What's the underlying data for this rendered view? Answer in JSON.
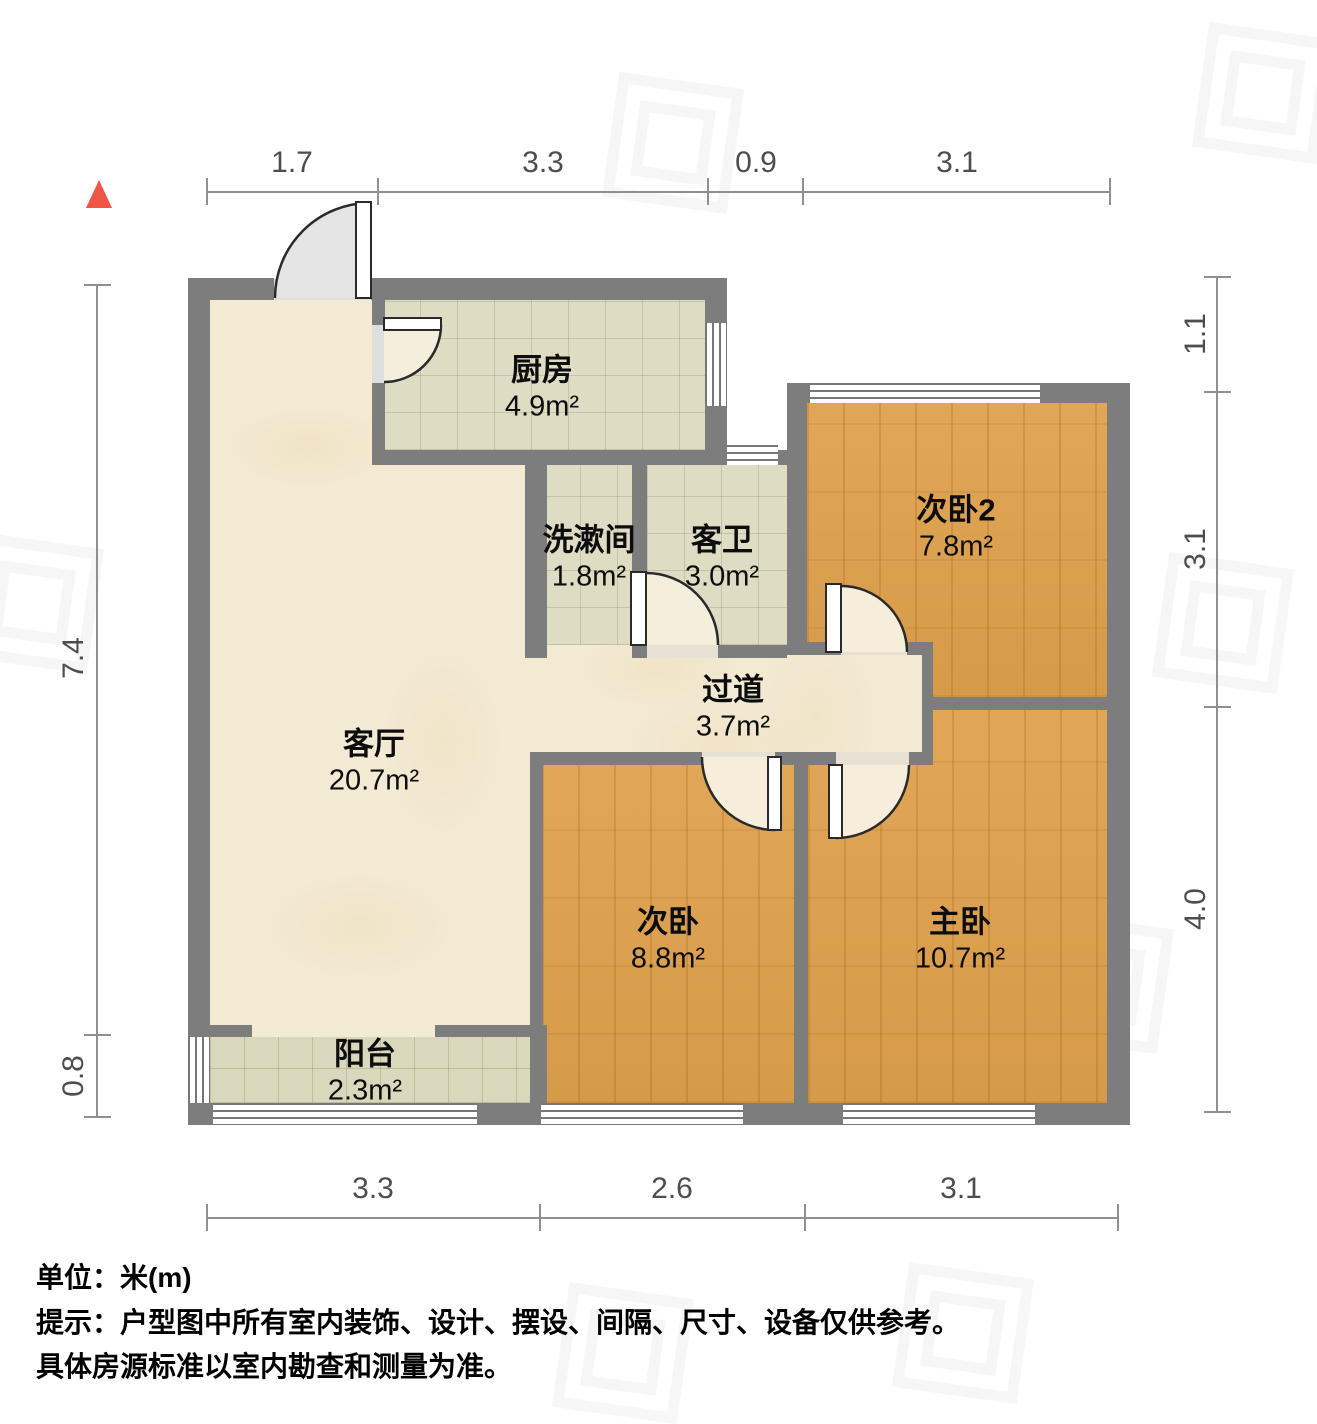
{
  "title": "户型图",
  "unit_scale": "米",
  "rooms": {
    "kitchen": {
      "name": "厨房",
      "area": "4.9m²"
    },
    "washroom": {
      "name": "洗漱间",
      "area": "1.8m²"
    },
    "guest_bath": {
      "name": "客卫",
      "area": "3.0m²"
    },
    "bedroom2": {
      "name": "次卧2",
      "area": "7.8m²"
    },
    "hallway": {
      "name": "过道",
      "area": "3.7m²"
    },
    "living": {
      "name": "客厅",
      "area": "20.7m²"
    },
    "bedroom": {
      "name": "次卧",
      "area": "8.8m²"
    },
    "master": {
      "name": "主卧",
      "area": "10.7m²"
    },
    "balcony": {
      "name": "阳台",
      "area": "2.3m²"
    }
  },
  "dims": {
    "top": [
      "1.7",
      "3.3",
      "0.9",
      "3.1"
    ],
    "bottom": [
      "3.3",
      "2.6",
      "3.1"
    ],
    "left": [
      "7.4",
      "0.8"
    ],
    "right": [
      "1.1",
      "3.1",
      "4.0"
    ]
  },
  "footer": {
    "unit": "单位：米(m)",
    "note1": "提示：户型图中所有室内装饰、设计、摆设、间隔、尺寸、设备仅供参考。",
    "note2": "具体房源标准以室内勘查和测量为准。"
  },
  "colors": {
    "wall": "#7d7d7d",
    "wood_floor": "#dfa14c",
    "tile_floor": "#dedcc3",
    "balcony_tile": "#d9d8bd",
    "marble_floor": "#f3ead3",
    "north_arrow_red": "#ef5545",
    "dim_text": "#4d4d4d"
  }
}
